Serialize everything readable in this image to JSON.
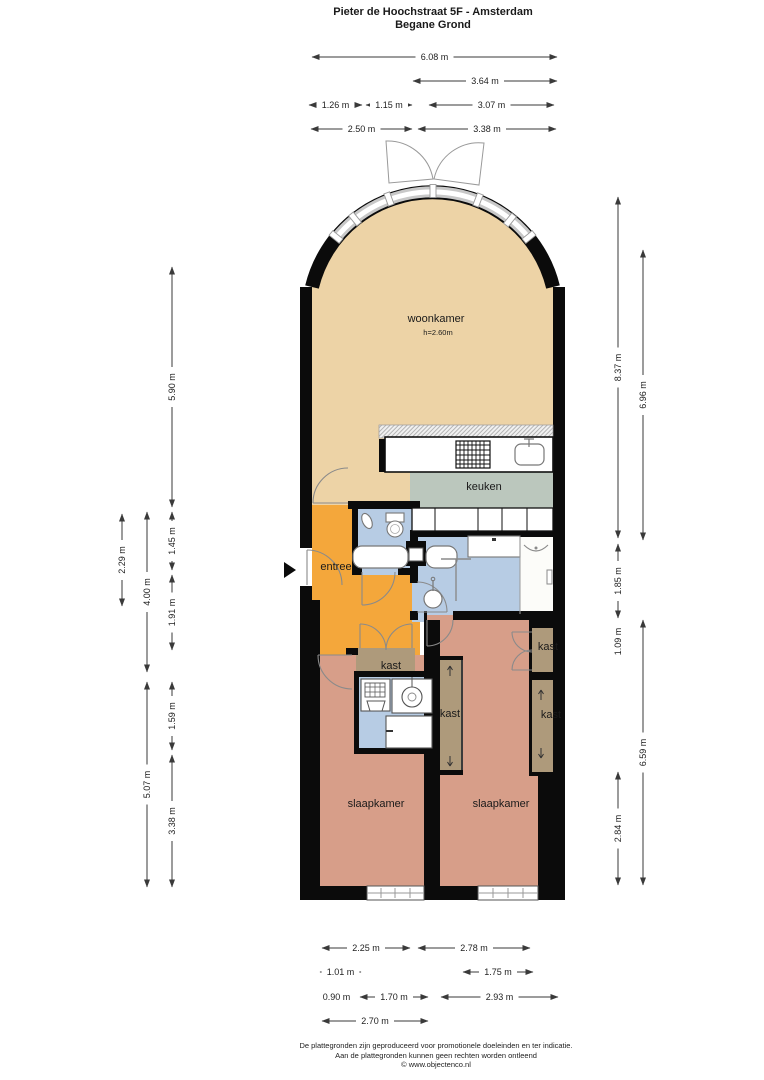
{
  "title": {
    "line1": "Pieter de Hoochstraat 5F - Amsterdam",
    "line2": "Begane Grond"
  },
  "plan": {
    "colors": {
      "woonkamer": "#EDD3A6",
      "keuken": "#BBC7BD",
      "entree": "#F4A73B",
      "badkamer": "#B7CCE4",
      "slaapkamer": "#D79E89",
      "kast": "#AE9A7B",
      "wall": "#0B0B0B"
    },
    "rooms": [
      {
        "id": "woonkamer",
        "label": "woonkamer",
        "sub": "h=2.60m",
        "x": 436,
        "y": 322
      },
      {
        "id": "keuken",
        "label": "keuken",
        "x": 484,
        "y": 490
      },
      {
        "id": "entree",
        "label": "entree",
        "x": 336,
        "y": 570
      },
      {
        "id": "kast-entree",
        "label": "kast",
        "x": 391,
        "y": 669
      },
      {
        "id": "kast-middle",
        "label": "kast",
        "x": 450,
        "y": 717
      },
      {
        "id": "kast-right-top",
        "label": "kast",
        "x": 548,
        "y": 650
      },
      {
        "id": "kast-right",
        "label": "kast",
        "x": 551,
        "y": 718
      },
      {
        "id": "slaapkamer-left",
        "label": "slaapkamer",
        "x": 376,
        "y": 807
      },
      {
        "id": "slaapkamer-right",
        "label": "slaapkamer",
        "x": 501,
        "y": 807
      }
    ],
    "dimensions": {
      "horizontal": [
        {
          "label": "6.08 m",
          "x1": 312,
          "x2": 557,
          "y": 57
        },
        {
          "label": "3.64 m",
          "x1": 413,
          "x2": 557,
          "y": 81
        },
        {
          "label": "1.26 m",
          "x1": 309,
          "x2": 362,
          "y": 105
        },
        {
          "label": "1.15 m",
          "x1": 366,
          "x2": 412,
          "y": 105
        },
        {
          "label": "3.07 m",
          "x1": 429,
          "x2": 554,
          "y": 105
        },
        {
          "label": "2.50 m",
          "x1": 311,
          "x2": 412,
          "y": 129
        },
        {
          "label": "3.38 m",
          "x1": 418,
          "x2": 556,
          "y": 129
        },
        {
          "label": "2.25 m",
          "x1": 322,
          "x2": 410,
          "y": 948
        },
        {
          "label": "2.78 m",
          "x1": 418,
          "x2": 530,
          "y": 948
        },
        {
          "label": "1.01 m",
          "x1": 320,
          "x2": 361,
          "y": 972
        },
        {
          "label": "1.75 m",
          "x1": 463,
          "x2": 533,
          "y": 972
        },
        {
          "label": "0.90 m",
          "x1": 320,
          "x2": 353,
          "y": 997
        },
        {
          "label": "1.70 m",
          "x1": 360,
          "x2": 428,
          "y": 997
        },
        {
          "label": "2.93 m",
          "x1": 441,
          "x2": 558,
          "y": 997
        },
        {
          "label": "2.70 m",
          "x1": 322,
          "x2": 428,
          "y": 1021
        }
      ],
      "vertical": [
        {
          "label": "2.29 m",
          "x": 122,
          "y1": 514,
          "y2": 606
        },
        {
          "label": "4.00 m",
          "x": 147,
          "y1": 512,
          "y2": 672
        },
        {
          "label": "5.07 m",
          "x": 147,
          "y1": 682,
          "y2": 887
        },
        {
          "label": "5.90 m",
          "x": 172,
          "y1": 267,
          "y2": 507
        },
        {
          "label": "1.45 m",
          "x": 172,
          "y1": 512,
          "y2": 570
        },
        {
          "label": "1.91 m",
          "x": 172,
          "y1": 575,
          "y2": 650
        },
        {
          "label": "1.59 m",
          "x": 172,
          "y1": 682,
          "y2": 750
        },
        {
          "label": "3.38 m",
          "x": 172,
          "y1": 755,
          "y2": 887
        },
        {
          "label": "8.37 m",
          "x": 618,
          "y1": 197,
          "y2": 538
        },
        {
          "label": "1.85 m",
          "x": 618,
          "y1": 544,
          "y2": 618
        },
        {
          "label": "1.09 m",
          "x": 618,
          "y1": 623,
          "y2": 660
        },
        {
          "label": "2.84 m",
          "x": 618,
          "y1": 772,
          "y2": 885
        },
        {
          "label": "6.96 m",
          "x": 643,
          "y1": 250,
          "y2": 540
        },
        {
          "label": "6.59 m",
          "x": 643,
          "y1": 620,
          "y2": 885
        }
      ]
    },
    "fixtures": [
      "gas-hob",
      "kitchen-sink",
      "kitchen-cabinets",
      "toilet",
      "hand-basin",
      "bathtub",
      "washbasin",
      "shower-screen",
      "washing-machine",
      "utility-cabinet",
      "entrance-arrow"
    ]
  },
  "footer": {
    "line1": "De plattegronden zijn geproduceerd voor promotionele doeleinden en ter indicatie.",
    "line2": "Aan de plattegronden kunnen geen rechten worden ontleend",
    "line3": "© www.objectenco.nl"
  }
}
